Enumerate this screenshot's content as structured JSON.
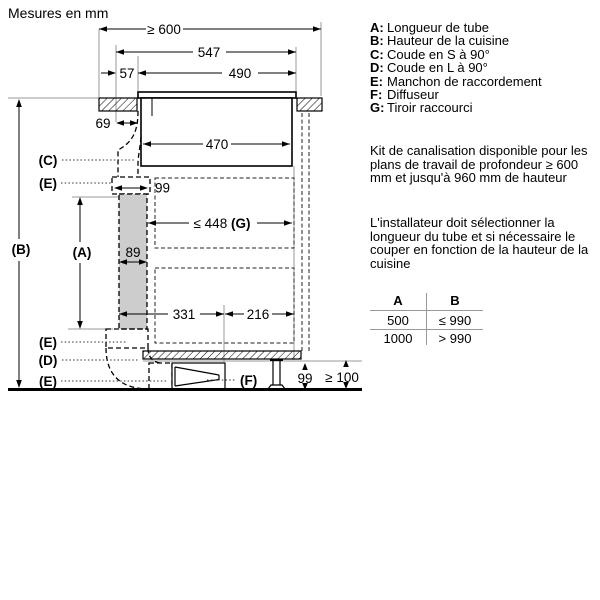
{
  "title": "Mesures en mm",
  "dims": {
    "worktop_min_depth": "≥ 600",
    "hob_overall": "547",
    "front_gap": "57",
    "cutout": "490",
    "rear_clearance": "69",
    "body_width": "470",
    "sleeve_width": "99",
    "tube_width": "89",
    "drawer_len": "≤ 448",
    "drawer_ref": "(G)",
    "span_left": "331",
    "span_right": "216",
    "plinth_height": "99",
    "plinth_min": "≥ 100"
  },
  "labels": {
    "tube": "(A)",
    "kitchen_height": "(B)",
    "s_bend": "(C)",
    "l_bend": "(D)",
    "sleeve_top": "(E)",
    "sleeve_mid": "(E)",
    "sleeve_bottom": "(E)",
    "diffuser": "(F)"
  },
  "legend": {
    "items": [
      {
        "key": "A:",
        "text": "Longueur de tube"
      },
      {
        "key": "B:",
        "text": "Hauteur de la cuisine"
      },
      {
        "key": "C:",
        "text": "Coude en S à 90°"
      },
      {
        "key": "D:",
        "text": "Coude en L à 90°"
      },
      {
        "key": "E:",
        "text": "Manchon de raccordement"
      },
      {
        "key": "F:",
        "text": "Diffuseur"
      },
      {
        "key": "G:",
        "text": "Tiroir raccourci"
      }
    ]
  },
  "notes": [
    "Kit de canalisation disponible pour les plans de travail de profondeur ≥ 600 mm et jusqu'à 960 mm de hauteur",
    "L'installateur doit sélectionner la longueur du tube et si nécessaire le couper en fonction de la hauteur de la cuisine"
  ],
  "table": {
    "headers": [
      "A",
      "B"
    ],
    "rows": [
      [
        "500",
        "≤ 990"
      ],
      [
        "1000",
        "> 990"
      ]
    ]
  }
}
